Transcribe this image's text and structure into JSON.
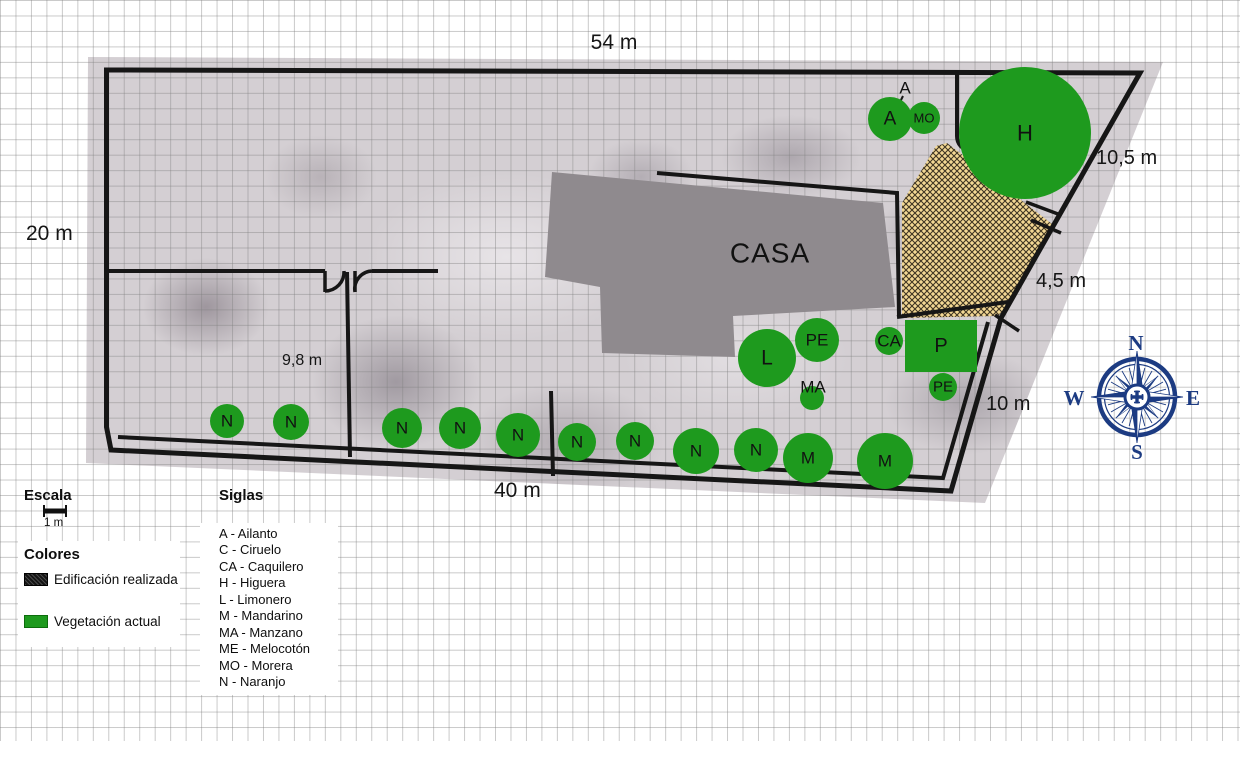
{
  "house_label": "CASA",
  "dimensions": {
    "top": "54 m",
    "left": "20 m",
    "right_upper": "10,5 m",
    "right_mid": "4,5 m",
    "right_lower": "10 m",
    "bottom": "40 m",
    "interior": "9,8 m"
  },
  "trees": {
    "a": "A",
    "mo": "MO",
    "h": "H",
    "l": "L",
    "pe": "PE",
    "ma": "MA",
    "ca": "CA",
    "p": "P",
    "n": "N",
    "m": "M"
  },
  "legend": {
    "scale_title": "Escala",
    "scale_value": "1 m",
    "colors_title": "Colores",
    "items": [
      {
        "label": "Edificación realizada",
        "swatch": "black-hatch"
      },
      {
        "label": "Vegetación actual",
        "swatch": "green"
      }
    ]
  },
  "siglas": {
    "title": "Siglas",
    "items": [
      "A - Ailanto",
      "C - Ciruelo",
      "CA - Caquilero",
      "H - Higuera",
      "L - Limonero",
      "M - Mandarino",
      "MA - Manzano",
      "ME - Melocotón",
      "MO - Morera",
      "N - Naranjo"
    ]
  },
  "compass": {
    "n": "N",
    "e": "E",
    "s": "S",
    "w": "W"
  },
  "colors": {
    "vegetation": "#1e9a1e",
    "building_fill": "#8f8a8e",
    "hatch_fill": "#f3d894",
    "boundary": "#161616",
    "compass_navy": "#1c3b82"
  }
}
